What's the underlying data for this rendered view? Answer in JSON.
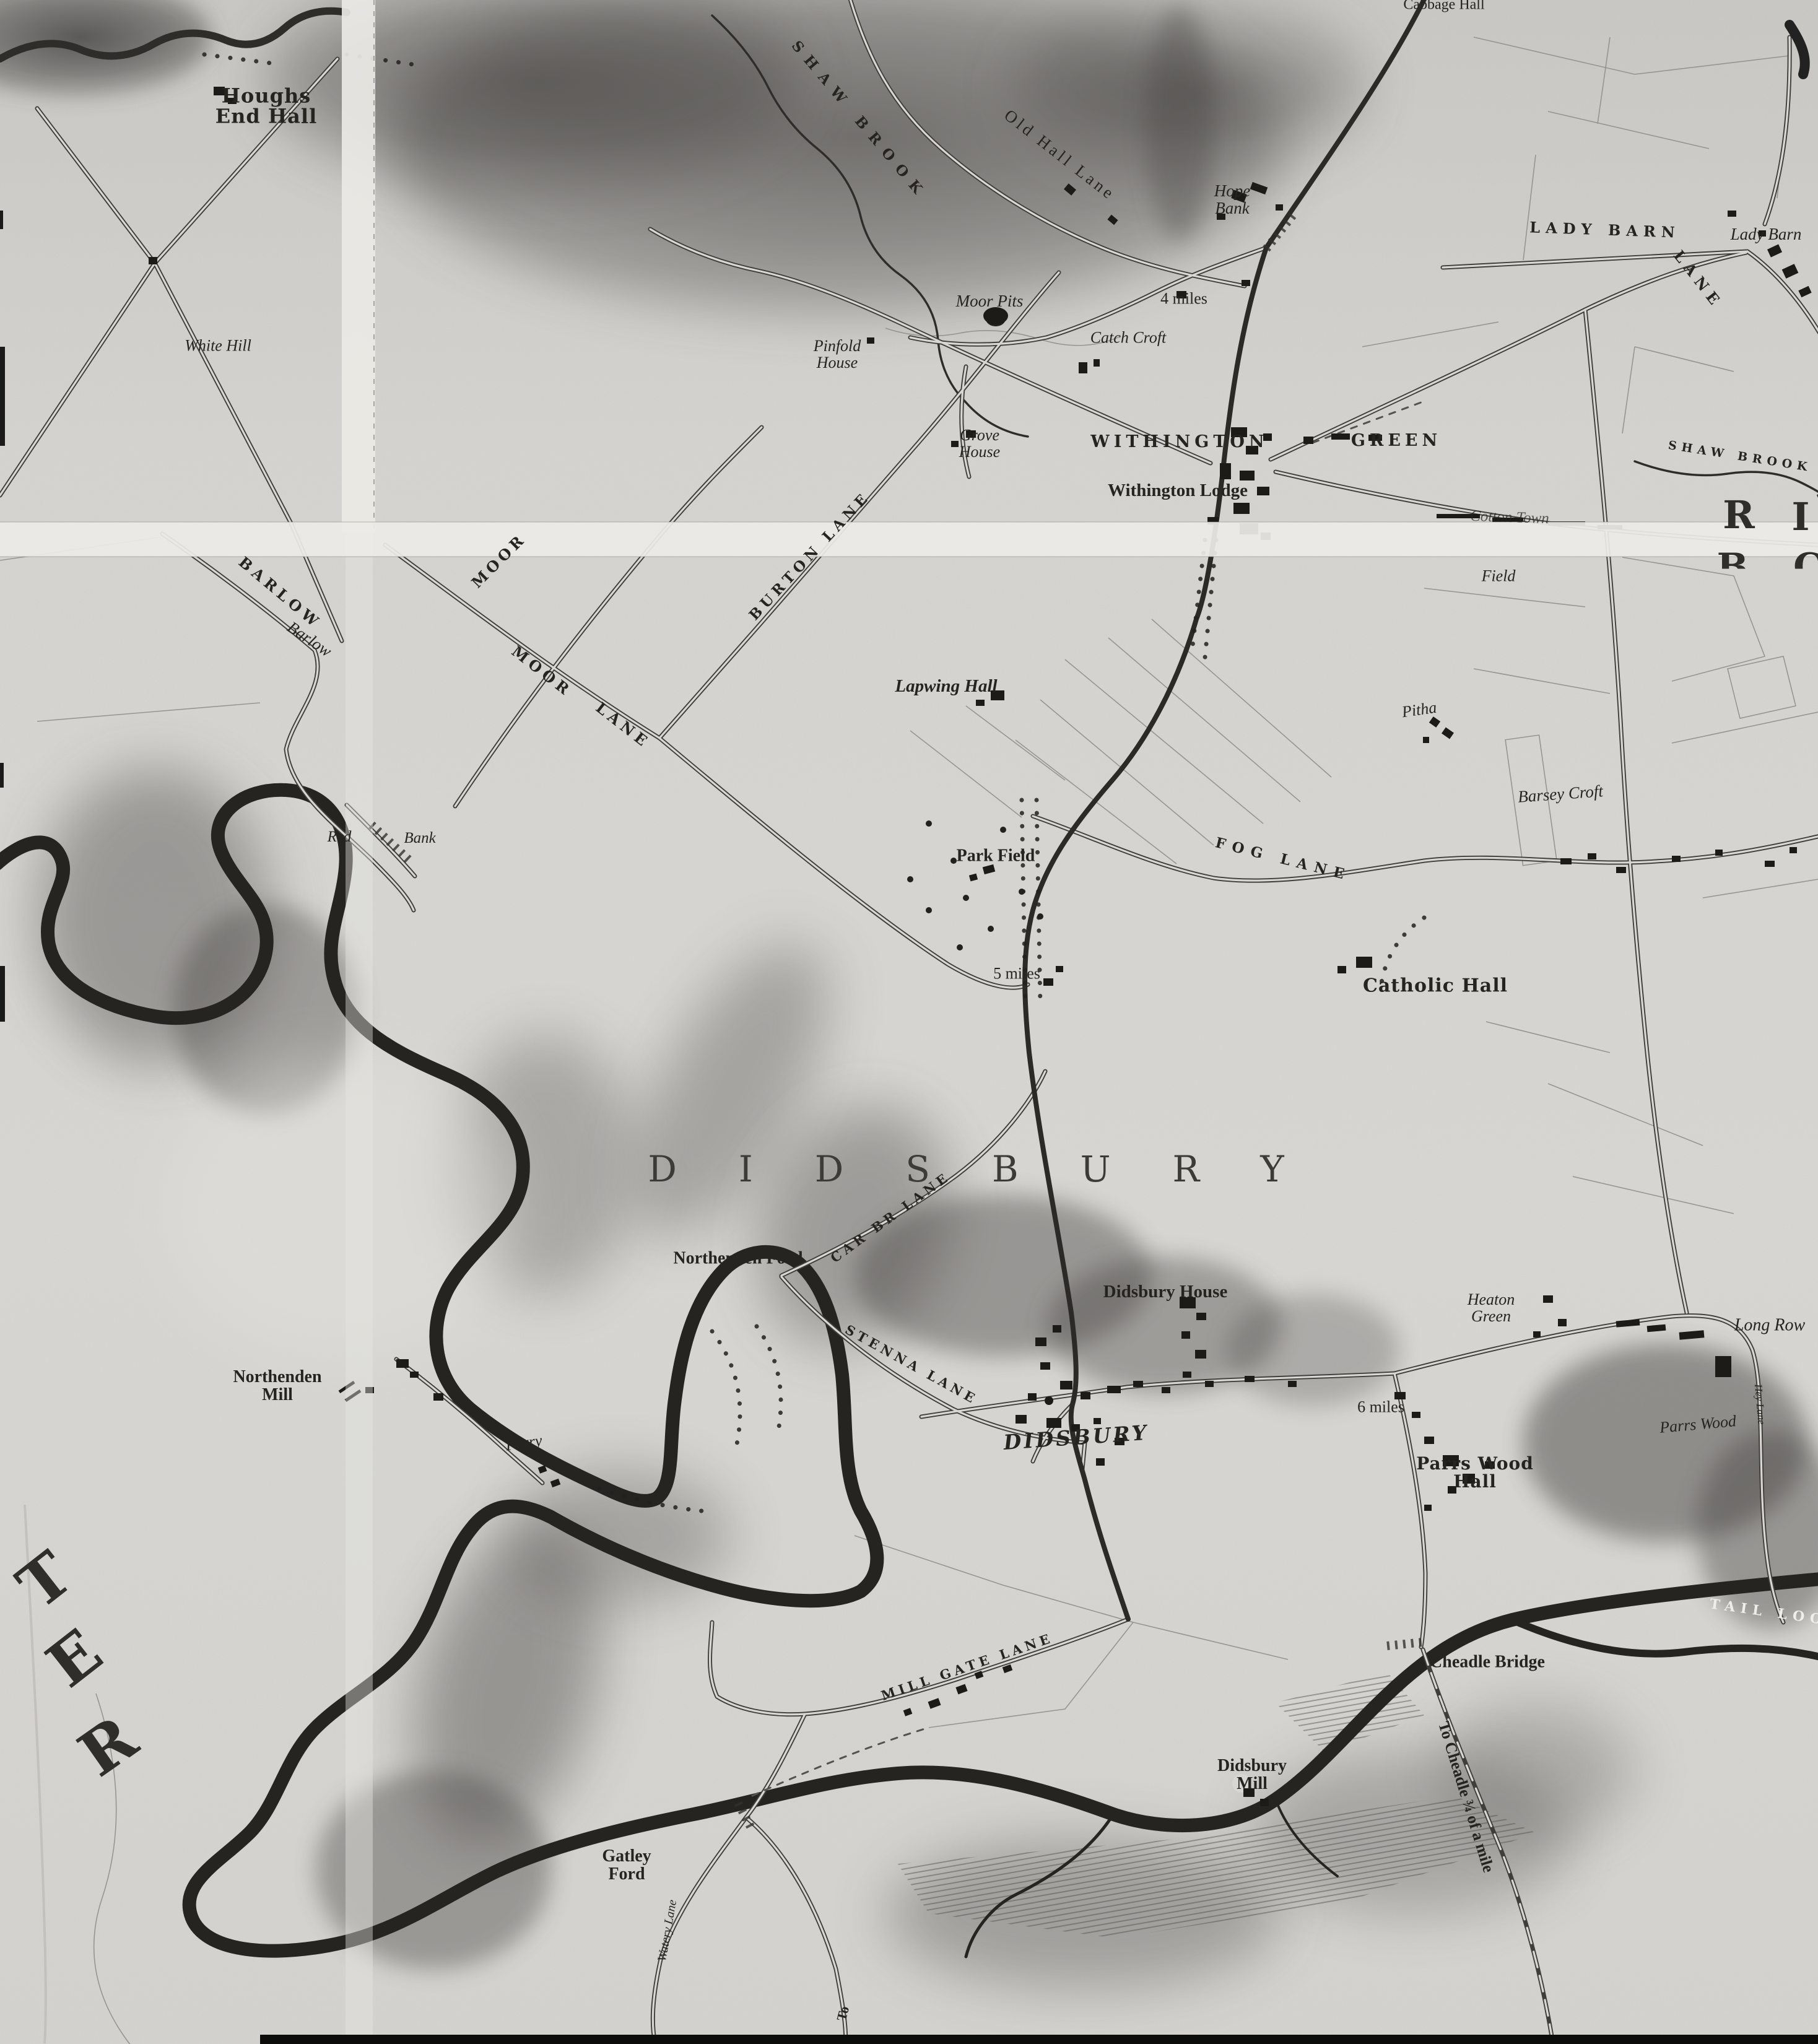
{
  "colors": {
    "paper": "#d7d6d2",
    "ink": "#26241f",
    "river": "#262421",
    "fold_band": "#ecebe7"
  },
  "labels": {
    "houghs_end_hall": "Houghs\nEnd Hall",
    "white_hill": "White Hill",
    "shaw_brook_upper": "SHAW BROOK",
    "old_hall_lane": "Old Hall Lane",
    "hope_bank": "Hope\nBank",
    "moor_pits": "Moor Pits",
    "miles4": "4 miles",
    "catch_croft": "Catch Croft",
    "pinfold_house": "Pinfold\nHouse",
    "grove_house": "Grove\nHouse",
    "withington": "WITHINGTON",
    "green": "GREEN",
    "withington_lodge": "Withington Lodge",
    "lady_barn_lane_1": "LADY BARN",
    "lady_barn_lane_2": "LANE",
    "lady_barn": "Lady Barn",
    "cabbage_hall": "Cabbage Hall",
    "shaw_brook_right": "SHAW BROOK",
    "sheet_letter_r": "R",
    "sheet_letter_i": "I",
    "sheet_letter_b": "B",
    "sheet_letter_c": "C",
    "cotton_town": "Cotton Town",
    "field": "Field",
    "barlow_caps": "BARLOW",
    "barlow_italic": "Barlow",
    "moor_fragment": "MOOR",
    "moor_lane_1": "MOOR",
    "moor_lane_2": "LANE",
    "burton_lane": "BURTON LANE",
    "lapwing_hall": "Lapwing Hall",
    "pitha": "Pitha",
    "barsey_croft": "Barsey Croft",
    "park_field": "Park Field",
    "fog_lane": "FOG LANE",
    "miles5": "5 miles",
    "catholic_hall": "Catholic Hall",
    "red_fragment": "Red",
    "bank_fragment": "Bank",
    "didsbury_large": "DIDSBURY",
    "northenden_ford": "Northenden Ford",
    "car_lane": "CAR BR LANE",
    "stenna_lane": "STENNA LANE",
    "didsbury_house": "Didsbury House",
    "heaton_green": "Heaton\nGreen",
    "long_row": "Long Row",
    "hey_lane": "Hey Lane",
    "northenden_mill": "Northenden\nMill",
    "ferry": "Ferry",
    "didsbury_village": "DIDSBURY",
    "miles6": "6 miles",
    "parrs_wood_hall": "Parrs Wood\nHall",
    "parrs_wood": "Parrs Wood",
    "cheadle_bridge": "Cheadle Bridge",
    "tail_loo": "TAIL LOO",
    "didsbury_mill": "Didsbury\nMill",
    "to_cheadle": "To Cheadle ¾ of a mile",
    "gatley_ford": "Gatley\nFord",
    "mill_gate_lane": "MILL GATE LANE",
    "watery_lane": "Watery Lane",
    "to_fragment": "To",
    "ter_t": "T",
    "ter_e": "E",
    "ter_r": "R"
  }
}
